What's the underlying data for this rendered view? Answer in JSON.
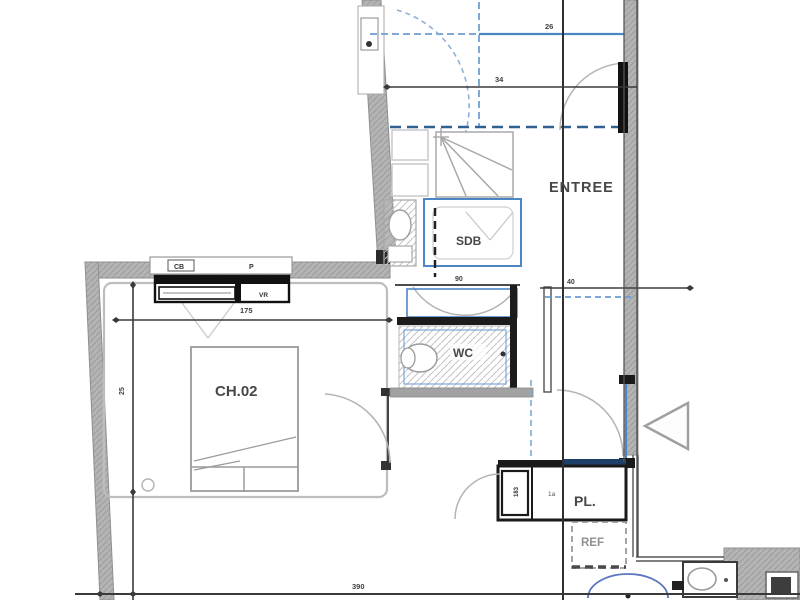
{
  "rooms": {
    "entree": "ENTREE",
    "sdb": "SDB",
    "wc": "WC",
    "chamber": "CH.02",
    "closet": "PL.",
    "fridge": "REF"
  },
  "window": {
    "shutter_box": "CB",
    "type": "P",
    "roller": "VR"
  },
  "dimensions": {
    "top_upper": "26",
    "top_lower": "34",
    "hall": "40",
    "wc_width": "90",
    "window_width": "175",
    "bedroom_depth": "25",
    "bottom_width": "390",
    "pl_side": "183",
    "pl_tick": "1a"
  },
  "colors": {
    "wall_gray": "#b4b4b4",
    "line_dark": "#3f3f3f",
    "blue": "#4d86c4",
    "light_blue": "#7fa8d9",
    "navy": "#1f3f6b",
    "arc_gray": "#b5b5b5",
    "kitchen_arc_blue": "#5b76c0"
  }
}
